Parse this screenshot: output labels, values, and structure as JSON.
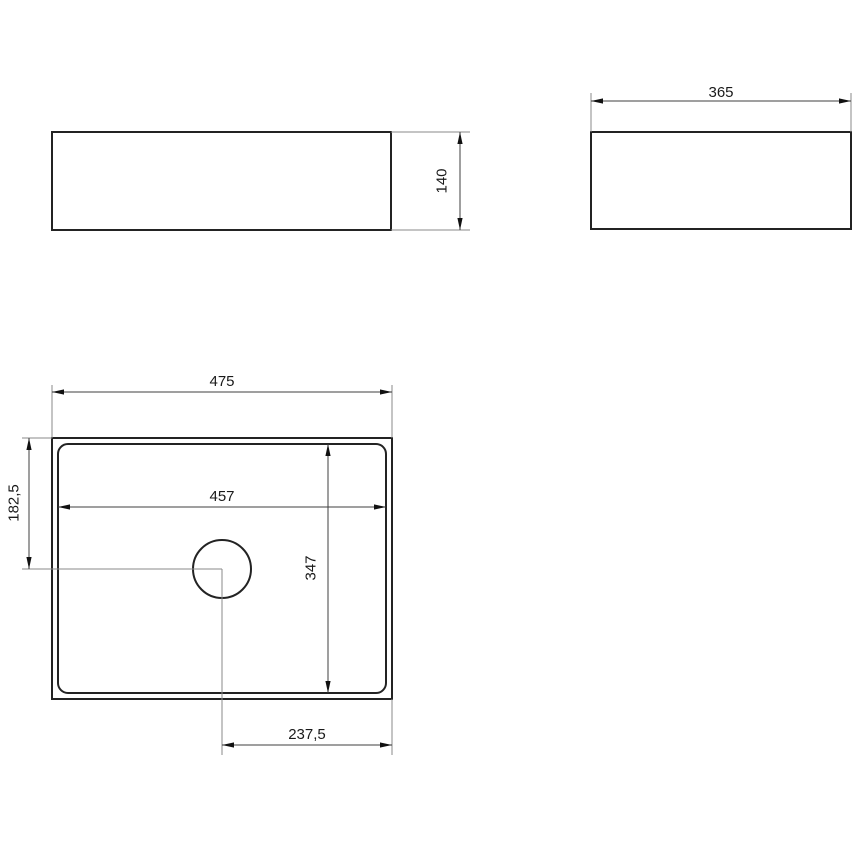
{
  "views": {
    "front": {
      "label_height": "140"
    },
    "side": {
      "label_width": "365"
    },
    "top": {
      "label_outer_width": "475",
      "label_inner_width": "457",
      "label_inner_depth": "347",
      "label_drain_offset_left": "182,5",
      "label_drain_offset_right": "237,5"
    }
  },
  "colors": {
    "background": "#ffffff",
    "outline": "#232323",
    "dimension_line": "#3f3f3f",
    "extension_line": "#8a8a8a",
    "text": "#1a1a1a"
  }
}
